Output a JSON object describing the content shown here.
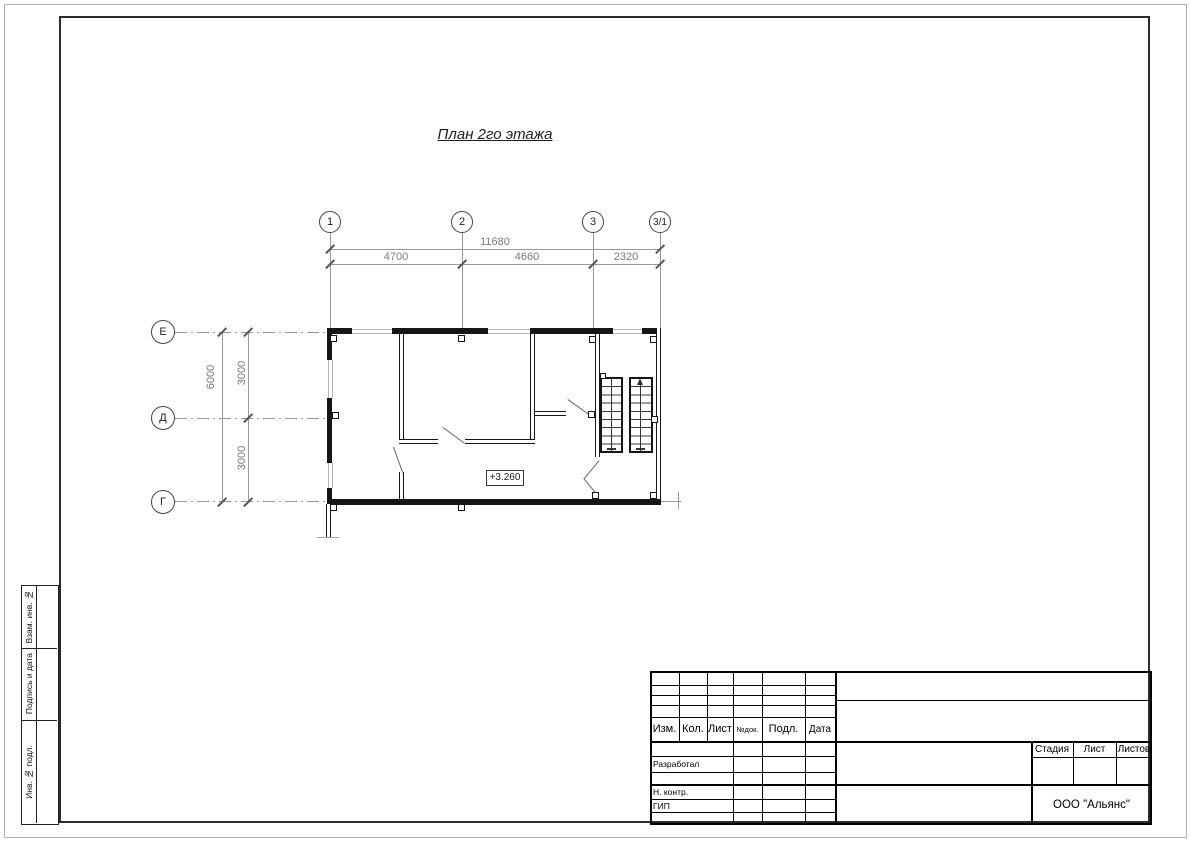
{
  "drawing": {
    "title": "План 2го этажа",
    "elevation_mark": "+3.260",
    "axes_top": [
      "1",
      "2",
      "3",
      "3/1"
    ],
    "axes_left": [
      "Е",
      "Д",
      "Г"
    ],
    "dims": {
      "total_width": "11680",
      "width_segments": [
        "4700",
        "4660",
        "2320"
      ],
      "total_height": "6000",
      "height_segments": [
        "3000",
        "3000"
      ]
    }
  },
  "titleblock": {
    "header_cols": [
      "Изм.",
      "Кол.",
      "Лист",
      "№док.",
      "Подл.",
      "Дата"
    ],
    "row_labels": [
      "Разработал",
      "Н. контр.",
      "ГИП"
    ],
    "stage_label": "Стадия",
    "sheet_label": "Лист",
    "sheets_label": "Листов",
    "company": "ООО \"Альянс\""
  },
  "side_labels": [
    "Взам. инв. №",
    "Подпись и дата",
    "Инв. № подл."
  ],
  "colors": {
    "wall": "#161616",
    "axis_line": "#999999",
    "dim_text": "#7a7a7a",
    "frame": "#2b2b2b"
  }
}
